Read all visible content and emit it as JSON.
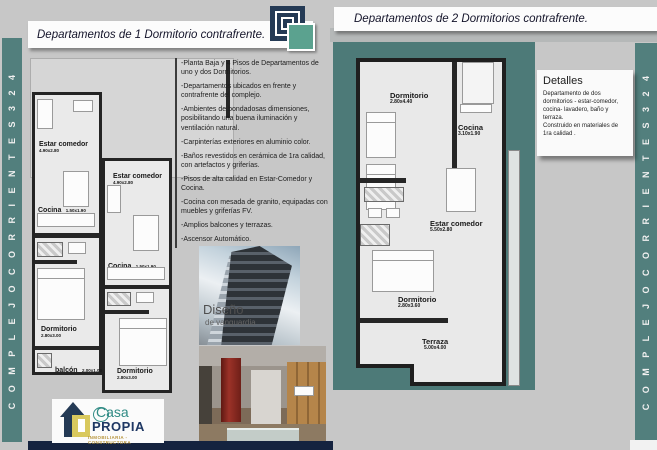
{
  "page": {
    "title_left": "Departamentos de 1 Dormitorio contrafrente.",
    "title_right": "Departamentos de 2 Dormitorios contrafrente.",
    "strip_text": "C O M P L E J O   C O R R I E N T E S   3 2 4"
  },
  "features": {
    "items": [
      "-Planta Baja y 4 Pisos de Departamentos de uno y dos  Dormitorios.",
      "-Departamentos ubicados en frente y contrafrente del complejo.",
      "-Ambientes de bondadosas dimensiones, posibilitando una buena iluminación y ventilación natural.",
      "-Carpinterías exteriores en aluminio color.",
      "-Baños revestidos en cerámica de 1ra calidad, con artefactos y griferías.",
      "-Pisos de alta calidad en Estar-Comedor y Cocina.",
      "-Cocina con mesada de granito, equipadas con muebles y griferías FV.",
      "-Amplios balcones y terrazas.",
      "-Ascensor Automático."
    ]
  },
  "details": {
    "title": "Detalles",
    "body": "Departamento de dos dormitorios -  estar-comedor, cocina- lavadero, baño y terraza.\nConstruido en materiales de 1ra calidad ."
  },
  "plan_a": {
    "estar": {
      "name": "Estar comedor",
      "dims": "4.90x2.80"
    },
    "cocina": {
      "name": "Cocina",
      "dims": "1.50x1.90"
    },
    "dorm": {
      "name": "Dormitorio",
      "dims": "2.80x3.00"
    },
    "balcon": {
      "name": "balcón",
      "dims": "2.00x1.00"
    }
  },
  "plan_b": {
    "estar": {
      "name": "Estar comedor",
      "dims": "4.90x2.80"
    },
    "cocina": {
      "name": "Cocina",
      "dims": "1.50x1.90"
    },
    "dorm": {
      "name": "Dormitorio",
      "dims": "2.80x3.00"
    }
  },
  "plan_c": {
    "dorm1": {
      "name": "Dormitorio",
      "dims": "2.80x4.40"
    },
    "cocina": {
      "name": "Cocina",
      "dims": "3.10x1.90"
    },
    "estar": {
      "name": "Estar comedor",
      "dims": "5.50x2.80"
    },
    "dorm2": {
      "name": "Dormitorio",
      "dims": "2.80x3.60"
    },
    "terraza": {
      "name": "Terraza",
      "dims": "5.00x4.00"
    }
  },
  "photo": {
    "overlay_line1": "Diseño",
    "overlay_line2": "de vanguardia"
  },
  "logo": {
    "casa": "Casa",
    "propia": "PROPIA",
    "subtitle": "INMOBILIARIA - CONSTRUCTORA"
  },
  "colors": {
    "teal_panel": "#4d7a78",
    "teal_strip": "#527f7d",
    "navy": "#243a55",
    "logo_teal": "#2f8a84",
    "logo_navy": "#1f3864",
    "logo_gold": "#b8963f"
  }
}
